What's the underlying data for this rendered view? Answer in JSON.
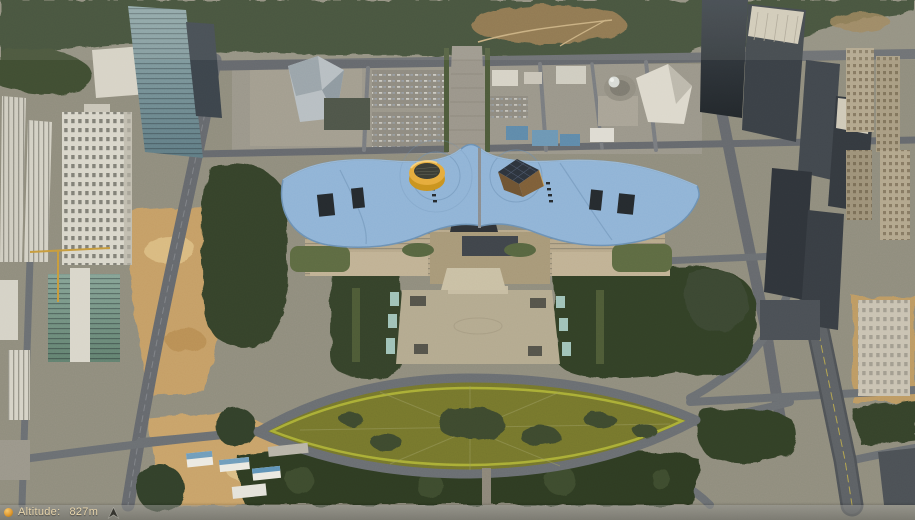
{
  "status_bar": {
    "altitude_label": "Altitude:",
    "altitude_value": "827m"
  },
  "icons": {
    "altitude_dot": "orange-dot-icon",
    "compass": "north-arrow-icon"
  },
  "colors": {
    "accent-orange": "#e0992f",
    "bar-text": "#e8d5ac",
    "arrow-dark": "#36352f",
    "roof-blue": "#8fb3d6",
    "roof-shadow": "#6b90b4",
    "cylinder-yellow": "#e5ab3c",
    "pyramid-brown": "#7d5e38",
    "plaza-tan": "#b3a98f",
    "park-olive": "#75762c",
    "tree-green": "#35422a",
    "road-gray": "#65686d",
    "construction-tan": "#c59e66"
  }
}
